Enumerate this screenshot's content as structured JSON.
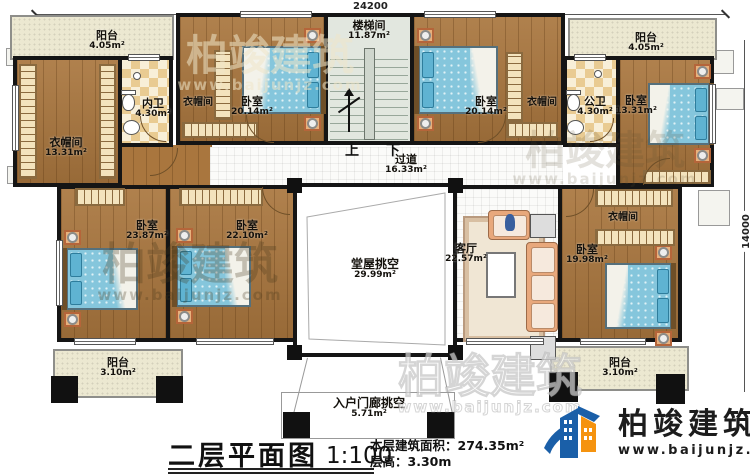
{
  "dims": {
    "width": "24200",
    "height": "14000"
  },
  "stair": {
    "up": "上",
    "down": "下"
  },
  "rooms": {
    "balcony_tl": {
      "name": "阳台",
      "area": "4.05m²"
    },
    "cloakroom_l": {
      "name": "衣帽间",
      "area": "13.31m²"
    },
    "inner_bath": {
      "name": "内卫",
      "area": "4.30m²"
    },
    "closet_tl": {
      "name": "衣帽间"
    },
    "bedroom_tl": {
      "name": "卧室",
      "area": "20.14m²"
    },
    "stairwell": {
      "name": "楼梯间",
      "area": "11.87m²"
    },
    "bedroom_tr": {
      "name": "卧室",
      "area": "20.14m²"
    },
    "closet_tr": {
      "name": "衣帽间"
    },
    "public_bath": {
      "name": "公卫",
      "area": "4.30m²"
    },
    "bedroom_r": {
      "name": "卧室",
      "area": "13.31m²"
    },
    "balcony_tr": {
      "name": "阳台",
      "area": "4.05m²"
    },
    "corridor": {
      "name": "过道",
      "area": "16.33m²"
    },
    "bedroom_l1": {
      "name": "卧室",
      "area": "23.87m²"
    },
    "bedroom_l2": {
      "name": "卧室",
      "area": "22.10m²"
    },
    "hall_void": {
      "name": "堂屋挑空",
      "area": "29.99m²"
    },
    "living": {
      "name": "客厅",
      "area": "22.57m²"
    },
    "closet_br": {
      "name": "衣帽间"
    },
    "bedroom_br": {
      "name": "卧室",
      "area": "19.98m²"
    },
    "balcony_bl": {
      "name": "阳台",
      "area": "3.10m²"
    },
    "balcony_br": {
      "name": "阳台",
      "area": "3.10m²"
    },
    "porch": {
      "name": "入户门廊挑空",
      "area": "5.71m²"
    }
  },
  "title": {
    "name": "二层平面图",
    "scale": "1:100",
    "area_label": "本层建筑面积：",
    "area_value": "274.35m²",
    "floor_label": "层高：",
    "floor_value": "3.30m"
  },
  "brand": {
    "name": "柏竣建筑",
    "site": "www.baijunjz.com"
  },
  "watermark": {
    "text": "柏竣建筑",
    "site": "www.baijunjz.com"
  },
  "colors": {
    "wall": "#151515",
    "wood": "#a9763e",
    "mattress": "#85c6dc",
    "balcony": "#ece8d1",
    "brand_blue": "#1a5fa8",
    "brand_orange": "#f5930f"
  }
}
